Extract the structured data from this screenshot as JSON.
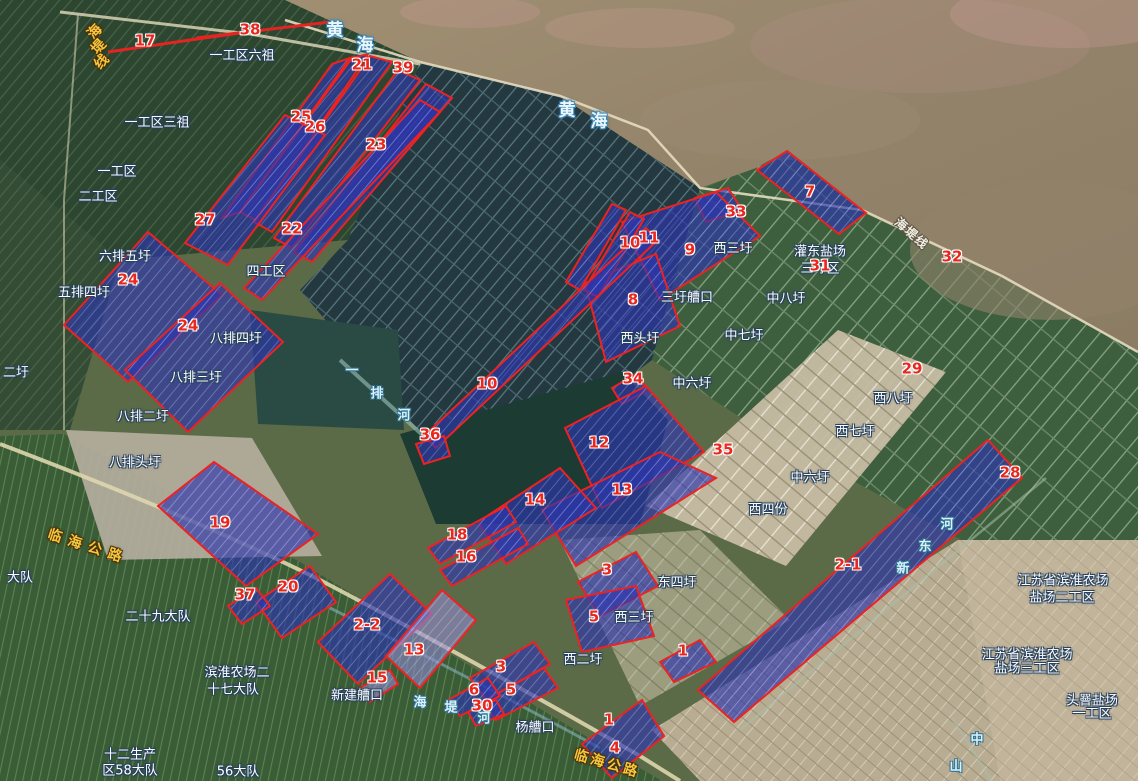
{
  "colors": {
    "parcel_fill": "#2d35ad",
    "parcel_stroke": "#ee2220",
    "number_color": "#e8281e",
    "place_label_color": "#ffffff",
    "road_label_color": "#f6c63e",
    "sea_label_color": "#eaf7ff",
    "river_label_color": "#d8f1fb"
  },
  "sea_label_chars": [
    {
      "text": "黄",
      "x": 335,
      "y": 31
    },
    {
      "text": "海",
      "x": 365,
      "y": 46
    },
    {
      "text": "黄",
      "x": 567,
      "y": 111
    },
    {
      "text": "海",
      "x": 599,
      "y": 122
    }
  ],
  "place_labels": [
    {
      "text": "一工区六祖",
      "x": 242,
      "y": 56
    },
    {
      "text": "一工区三祖",
      "x": 157,
      "y": 123
    },
    {
      "text": "一工区",
      "x": 117,
      "y": 172
    },
    {
      "text": "二工区",
      "x": 98,
      "y": 197
    },
    {
      "text": "四工区",
      "x": 266,
      "y": 272
    },
    {
      "text": "六排五圩",
      "x": 125,
      "y": 257
    },
    {
      "text": "五排四圩",
      "x": 84,
      "y": 293
    },
    {
      "text": "八排四圩",
      "x": 236,
      "y": 339
    },
    {
      "text": "八排三圩",
      "x": 196,
      "y": 378
    },
    {
      "text": "八排二圩",
      "x": 143,
      "y": 417
    },
    {
      "text": "八排头圩",
      "x": 135,
      "y": 463
    },
    {
      "text": "二圩",
      "x": 16,
      "y": 373
    },
    {
      "text": "大队",
      "x": 20,
      "y": 578
    },
    {
      "text": "二十九大队",
      "x": 158,
      "y": 617
    },
    {
      "text": "滨淮农场二",
      "x": 237,
      "y": 673
    },
    {
      "text": "十七大队",
      "x": 233,
      "y": 690
    },
    {
      "text": "新建艚口",
      "x": 357,
      "y": 696
    },
    {
      "text": "杨艚口",
      "x": 535,
      "y": 728
    },
    {
      "text": "三圩艚口",
      "x": 687,
      "y": 298
    },
    {
      "text": "西三圩",
      "x": 733,
      "y": 249
    },
    {
      "text": "灌东盐场",
      "x": 820,
      "y": 252
    },
    {
      "text": "三圩区",
      "x": 820,
      "y": 269
    },
    {
      "text": "中八圩",
      "x": 786,
      "y": 299
    },
    {
      "text": "中七圩",
      "x": 744,
      "y": 336
    },
    {
      "text": "西头圩",
      "x": 640,
      "y": 339
    },
    {
      "text": "中六圩",
      "x": 692,
      "y": 384
    },
    {
      "text": "中六圩",
      "x": 810,
      "y": 478
    },
    {
      "text": "西八圩",
      "x": 893,
      "y": 399
    },
    {
      "text": "西七圩",
      "x": 855,
      "y": 432
    },
    {
      "text": "西四份",
      "x": 768,
      "y": 510
    },
    {
      "text": "东四圩",
      "x": 677,
      "y": 583
    },
    {
      "text": "西三圩",
      "x": 634,
      "y": 618
    },
    {
      "text": "西二圩",
      "x": 583,
      "y": 660
    },
    {
      "text": "江苏省滨淮农场",
      "x": 1063,
      "y": 581
    },
    {
      "text": "盐场二工区",
      "x": 1062,
      "y": 598
    },
    {
      "text": "江苏省滨淮农场",
      "x": 1027,
      "y": 655
    },
    {
      "text": "盐场三工区",
      "x": 1027,
      "y": 669
    },
    {
      "text": "头罾盐场",
      "x": 1092,
      "y": 701
    },
    {
      "text": "一工区",
      "x": 1092,
      "y": 714
    },
    {
      "text": "十二生产",
      "x": 130,
      "y": 755
    },
    {
      "text": "区58大队",
      "x": 130,
      "y": 771
    },
    {
      "text": "56大队",
      "x": 238,
      "y": 772
    }
  ],
  "road_labels": [
    {
      "text": "临海公路",
      "x": 88,
      "y": 547,
      "rot": 18,
      "ls": 7,
      "cls": "road"
    },
    {
      "text": "临海公路",
      "x": 607,
      "y": 764,
      "rot": 16,
      "ls": 3,
      "cls": "road"
    }
  ],
  "road_label_chars": [
    {
      "text": "海",
      "x": 95,
      "y": 32,
      "rot": -47,
      "cls": "road"
    },
    {
      "text": "堤",
      "x": 99,
      "y": 47,
      "rot": -47,
      "cls": "road"
    },
    {
      "text": "线",
      "x": 102,
      "y": 62,
      "rot": -47,
      "cls": "road"
    },
    {
      "text": "海",
      "x": 901,
      "y": 224,
      "rot": 40,
      "cls": "roadw"
    },
    {
      "text": "堤",
      "x": 911,
      "y": 233,
      "rot": 40,
      "cls": "roadw"
    },
    {
      "text": "线",
      "x": 921,
      "y": 242,
      "rot": 40,
      "cls": "roadw"
    }
  ],
  "river_label_chars": [
    {
      "text": "海",
      "x": 420,
      "y": 703
    },
    {
      "text": "堤",
      "x": 451,
      "y": 708
    },
    {
      "text": "河",
      "x": 484,
      "y": 719
    },
    {
      "text": "一",
      "x": 352,
      "y": 371
    },
    {
      "text": "排",
      "x": 377,
      "y": 394
    },
    {
      "text": "河",
      "x": 404,
      "y": 416
    },
    {
      "text": "新",
      "x": 903,
      "y": 569
    },
    {
      "text": "东",
      "x": 925,
      "y": 547
    },
    {
      "text": "河",
      "x": 947,
      "y": 525
    },
    {
      "text": "中",
      "x": 977,
      "y": 740
    },
    {
      "text": "山",
      "x": 956,
      "y": 767
    }
  ],
  "parcel_numbers": [
    {
      "n": "17",
      "x": 145,
      "y": 41
    },
    {
      "n": "38",
      "x": 250,
      "y": 30
    },
    {
      "n": "21",
      "x": 362,
      "y": 65
    },
    {
      "n": "39",
      "x": 403,
      "y": 68
    },
    {
      "n": "25",
      "x": 301,
      "y": 117
    },
    {
      "n": "26",
      "x": 315,
      "y": 127
    },
    {
      "n": "23",
      "x": 376,
      "y": 145
    },
    {
      "n": "27",
      "x": 205,
      "y": 220
    },
    {
      "n": "22",
      "x": 292,
      "y": 229
    },
    {
      "n": "24",
      "x": 128,
      "y": 280
    },
    {
      "n": "24",
      "x": 188,
      "y": 326
    },
    {
      "n": "10",
      "x": 630,
      "y": 243
    },
    {
      "n": "11",
      "x": 649,
      "y": 238
    },
    {
      "n": "9",
      "x": 690,
      "y": 250
    },
    {
      "n": "33",
      "x": 736,
      "y": 212
    },
    {
      "n": "7",
      "x": 810,
      "y": 192
    },
    {
      "n": "32",
      "x": 952,
      "y": 257
    },
    {
      "n": "31",
      "x": 820,
      "y": 266
    },
    {
      "n": "8",
      "x": 633,
      "y": 300
    },
    {
      "n": "34",
      "x": 633,
      "y": 379
    },
    {
      "n": "29",
      "x": 912,
      "y": 369
    },
    {
      "n": "10",
      "x": 487,
      "y": 384
    },
    {
      "n": "36",
      "x": 430,
      "y": 435
    },
    {
      "n": "12",
      "x": 599,
      "y": 443
    },
    {
      "n": "35",
      "x": 723,
      "y": 450
    },
    {
      "n": "28",
      "x": 1010,
      "y": 473
    },
    {
      "n": "13",
      "x": 622,
      "y": 490
    },
    {
      "n": "14",
      "x": 535,
      "y": 500
    },
    {
      "n": "18",
      "x": 457,
      "y": 535
    },
    {
      "n": "16",
      "x": 466,
      "y": 557
    },
    {
      "n": "19",
      "x": 220,
      "y": 523
    },
    {
      "n": "20",
      "x": 288,
      "y": 587
    },
    {
      "n": "37",
      "x": 245,
      "y": 595
    },
    {
      "n": "2-1",
      "x": 848,
      "y": 565
    },
    {
      "n": "2-2",
      "x": 367,
      "y": 625
    },
    {
      "n": "13",
      "x": 414,
      "y": 650
    },
    {
      "n": "15",
      "x": 377,
      "y": 678
    },
    {
      "n": "3",
      "x": 607,
      "y": 570
    },
    {
      "n": "5",
      "x": 594,
      "y": 617
    },
    {
      "n": "3",
      "x": 501,
      "y": 667
    },
    {
      "n": "5",
      "x": 511,
      "y": 690
    },
    {
      "n": "6",
      "x": 474,
      "y": 690
    },
    {
      "n": "30",
      "x": 482,
      "y": 706
    },
    {
      "n": "1",
      "x": 683,
      "y": 651
    },
    {
      "n": "1",
      "x": 609,
      "y": 720
    },
    {
      "n": "4",
      "x": 615,
      "y": 748
    }
  ],
  "parcels": [
    {
      "n": "17",
      "line": true,
      "points": "108,52 190,40 240,33"
    },
    {
      "n": "38",
      "line": true,
      "points": "196,38 330,22"
    },
    {
      "n": "25",
      "points": "332,64 350,58 240,212 222,218"
    },
    {
      "n": "26",
      "points": "352,58 368,54 256,220 240,212"
    },
    {
      "n": "21",
      "points": "370,56 392,62 272,232 254,222"
    },
    {
      "n": "39",
      "points": "398,70 420,80 292,248 274,238"
    },
    {
      "n": "23",
      "points": "426,84 452,98 312,262 294,252"
    },
    {
      "n": "22",
      "points": "420,100 440,112 262,300 244,288"
    },
    {
      "n": "27",
      "points": "285,115 325,135 228,265 185,243"
    },
    {
      "n": "24a",
      "points": "64,325 148,232 222,295 128,382"
    },
    {
      "n": "24b",
      "points": "125,370 220,283 283,342 188,432"
    },
    {
      "n": "7",
      "points": "757,170 787,151 866,213 839,234"
    },
    {
      "n": "33",
      "points": "695,198 728,188 742,210 706,222"
    },
    {
      "n": "9",
      "points": "622,222 716,192 760,236 660,300"
    },
    {
      "n": "8",
      "points": "585,283 656,254 680,326 606,362"
    },
    {
      "n": "10a",
      "points": "612,204 626,210 580,290 566,282"
    },
    {
      "n": "11",
      "points": "630,212 644,219 598,297 584,290"
    },
    {
      "n": "10b",
      "points": "424,436 646,228 658,240 436,448"
    },
    {
      "n": "36",
      "points": "416,444 444,436 450,456 424,464"
    },
    {
      "n": "34",
      "points": "612,388 636,374 648,390 622,404"
    },
    {
      "n": "12",
      "points": "565,428 646,386 704,452 602,508"
    },
    {
      "n": "13a",
      "points": "542,510 660,452 716,478 576,566"
    },
    {
      "n": "14",
      "points": "478,522 560,468 596,508 506,564"
    },
    {
      "n": "18",
      "points": "428,548 506,506 516,522 440,564"
    },
    {
      "n": "16",
      "points": "440,570 518,528 528,544 452,586"
    },
    {
      "n": "3a",
      "points": "578,582 636,552 658,586 600,616"
    },
    {
      "n": "5a",
      "points": "566,600 636,586 654,636 582,652"
    },
    {
      "n": "3b",
      "points": "470,678 534,642 550,664 486,700"
    },
    {
      "n": "5b",
      "points": "482,702 544,668 558,688 496,720"
    },
    {
      "n": "6",
      "points": "448,700 488,678 500,696 460,716"
    },
    {
      "n": "30",
      "points": "468,712 496,700 504,714 476,726"
    },
    {
      "n": "1a",
      "points": "660,662 700,640 716,662 674,682"
    },
    {
      "n": "1-4",
      "points": "582,744 642,700 664,736 612,778"
    },
    {
      "n": "2-1",
      "points": "698,690 988,440 1022,478 734,722"
    },
    {
      "n": "19",
      "points": "158,506 214,462 318,534 246,586"
    },
    {
      "n": "20",
      "points": "256,602 310,566 336,602 282,638"
    },
    {
      "n": "37",
      "points": "228,606 256,588 270,606 242,624"
    },
    {
      "n": "2-2",
      "points": "318,642 390,574 432,614 358,684"
    },
    {
      "n": "13b",
      "light": true,
      "points": "386,656 442,590 476,620 420,688"
    },
    {
      "n": "15",
      "light": true,
      "points": "360,688 390,670 398,684 370,702"
    }
  ]
}
